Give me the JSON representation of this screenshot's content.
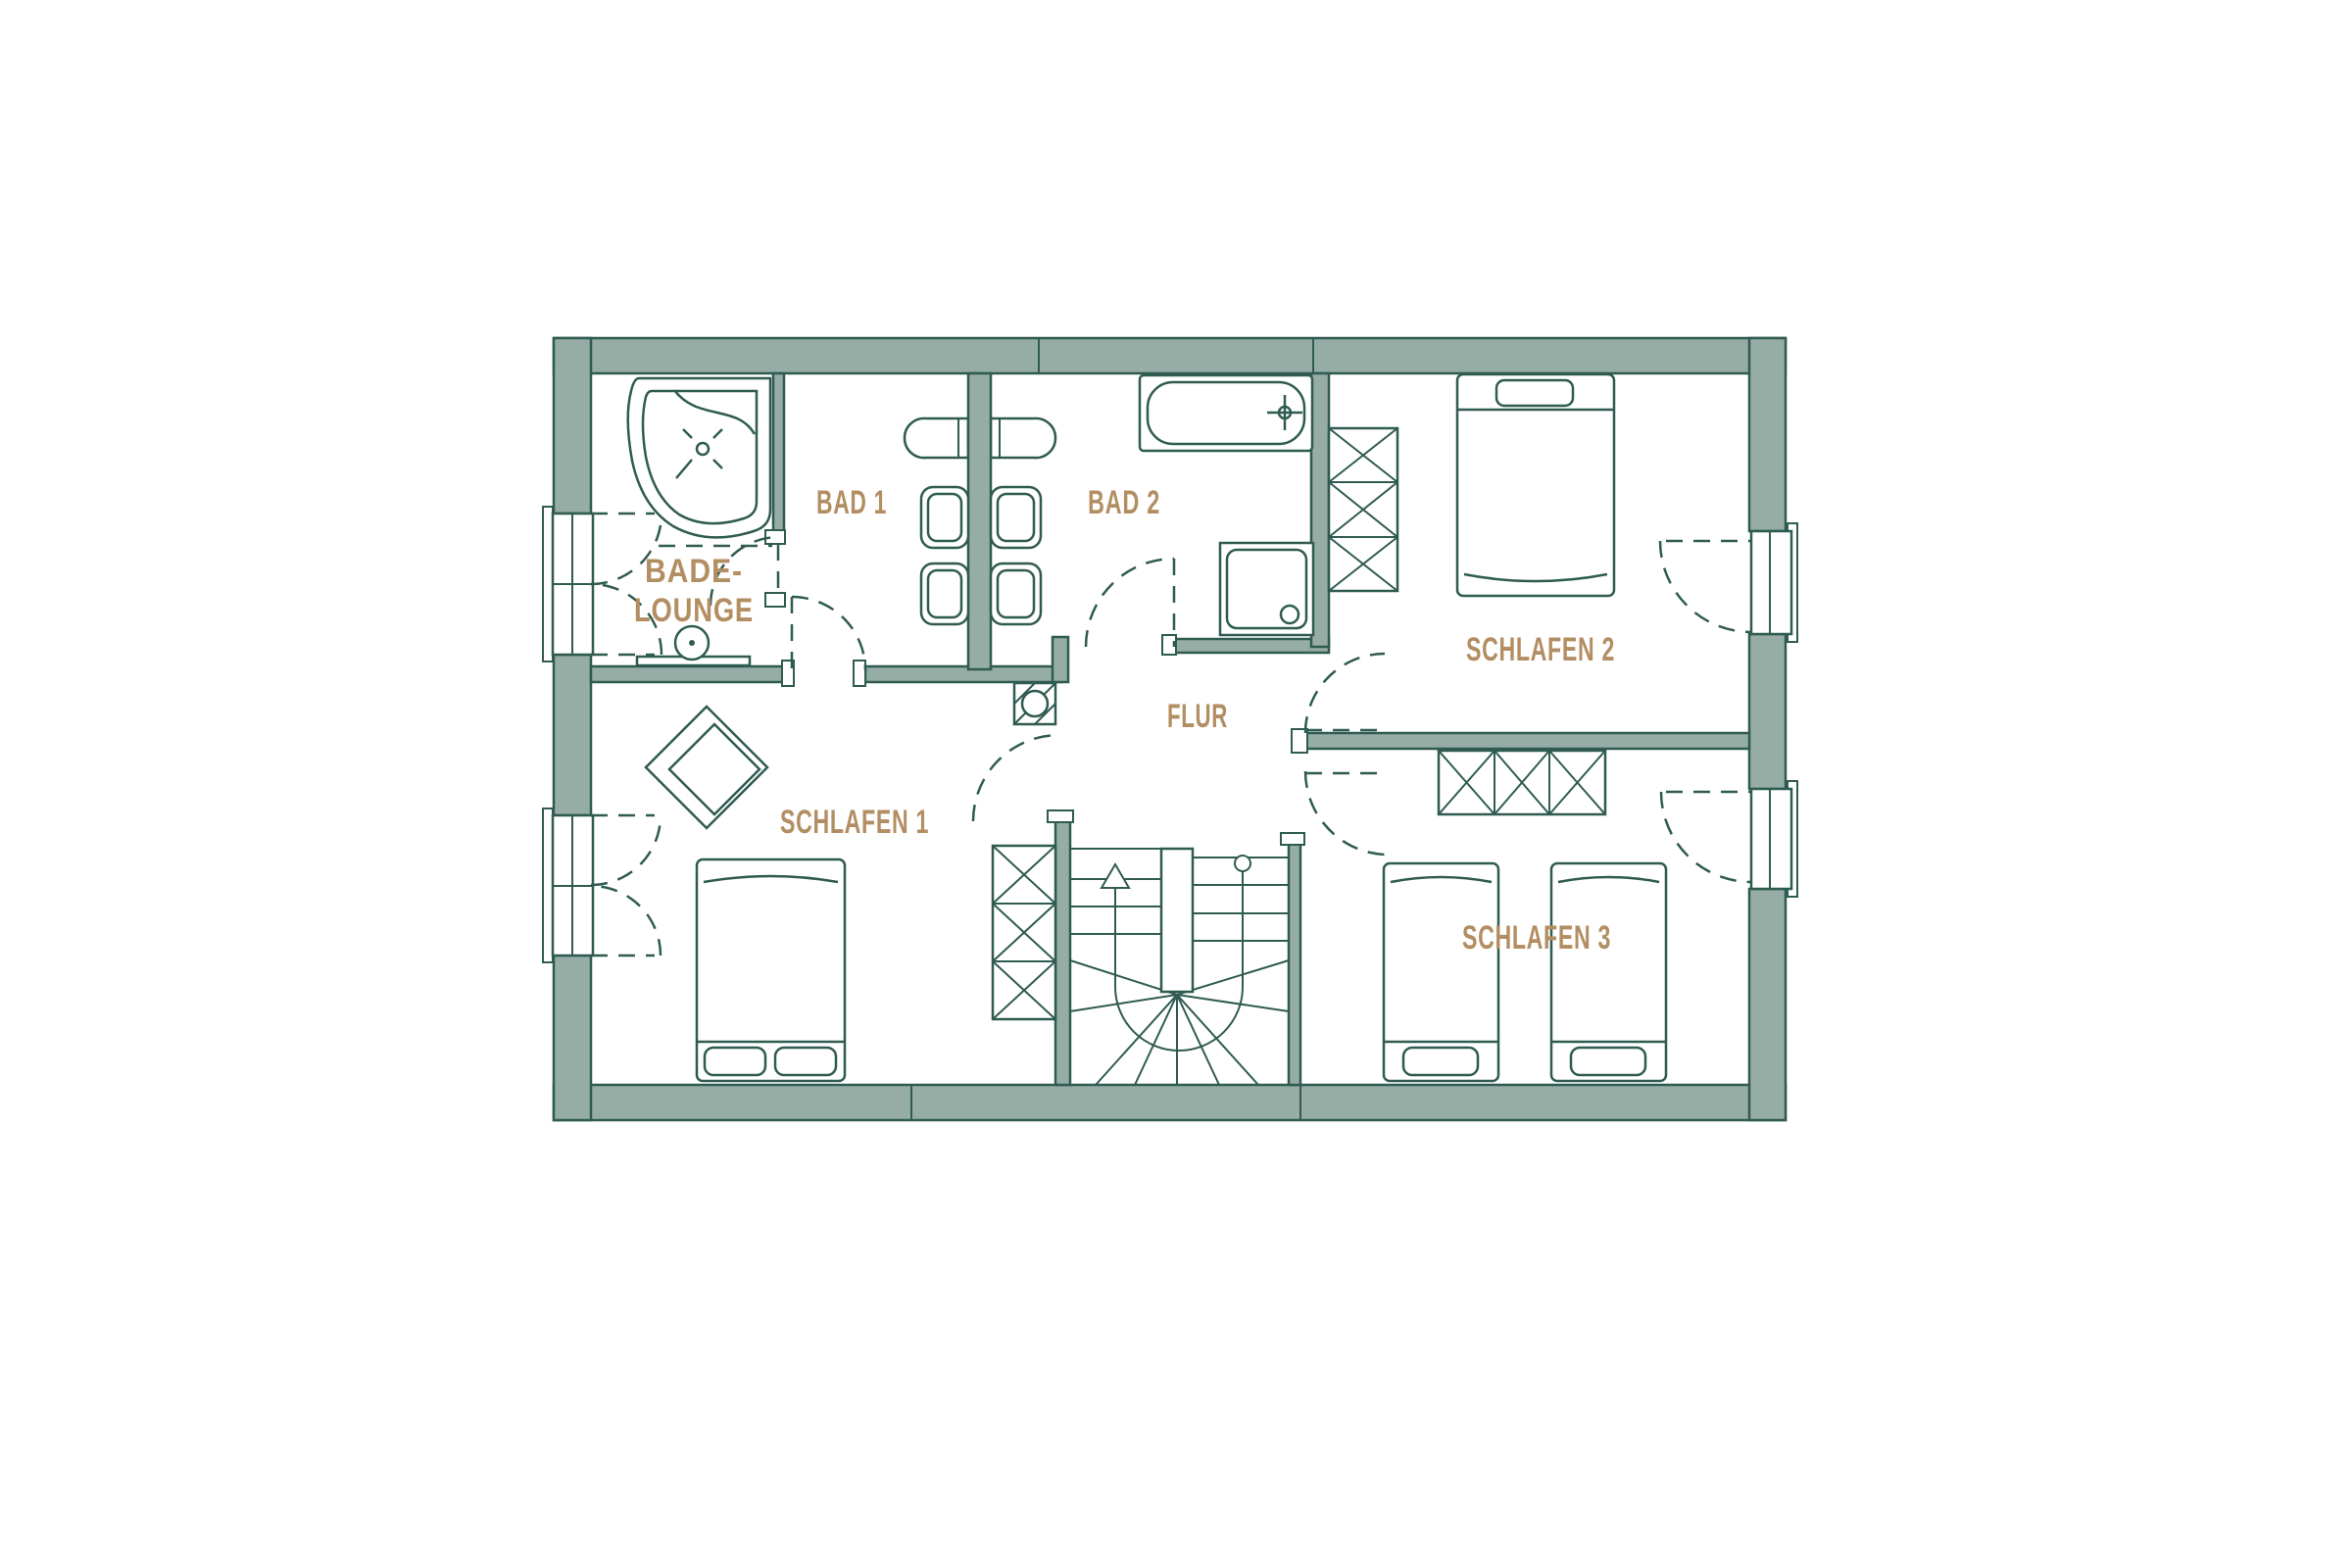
{
  "document": {
    "type": "floor-plan",
    "floor": "upper-floor"
  },
  "colors": {
    "wall_fill": "#96ada6",
    "line": "#2f5b51",
    "room_label": "#b28e62",
    "background": "#ffffff"
  },
  "rooms": {
    "bade_lounge": {
      "label_line1": "BADE-",
      "label_line2": "LOUNGE"
    },
    "bad1": {
      "label": "BAD 1"
    },
    "bad2": {
      "label": "BAD 2"
    },
    "flur": {
      "label": "FLUR"
    },
    "schlafen1": {
      "label": "SCHLAFEN 1"
    },
    "schlafen2": {
      "label": "SCHLAFEN 2"
    },
    "schlafen3": {
      "label": "SCHLAFEN 3"
    }
  },
  "fixtures": [
    "corner-bathtub",
    "pedestal-sink",
    "double-washbasin",
    "wc",
    "bidet",
    "bathtub",
    "shower",
    "chimney",
    "wardrobe",
    "double-bed",
    "single-bed",
    "armchair",
    "winder-staircase",
    "french-window",
    "door-swing"
  ]
}
